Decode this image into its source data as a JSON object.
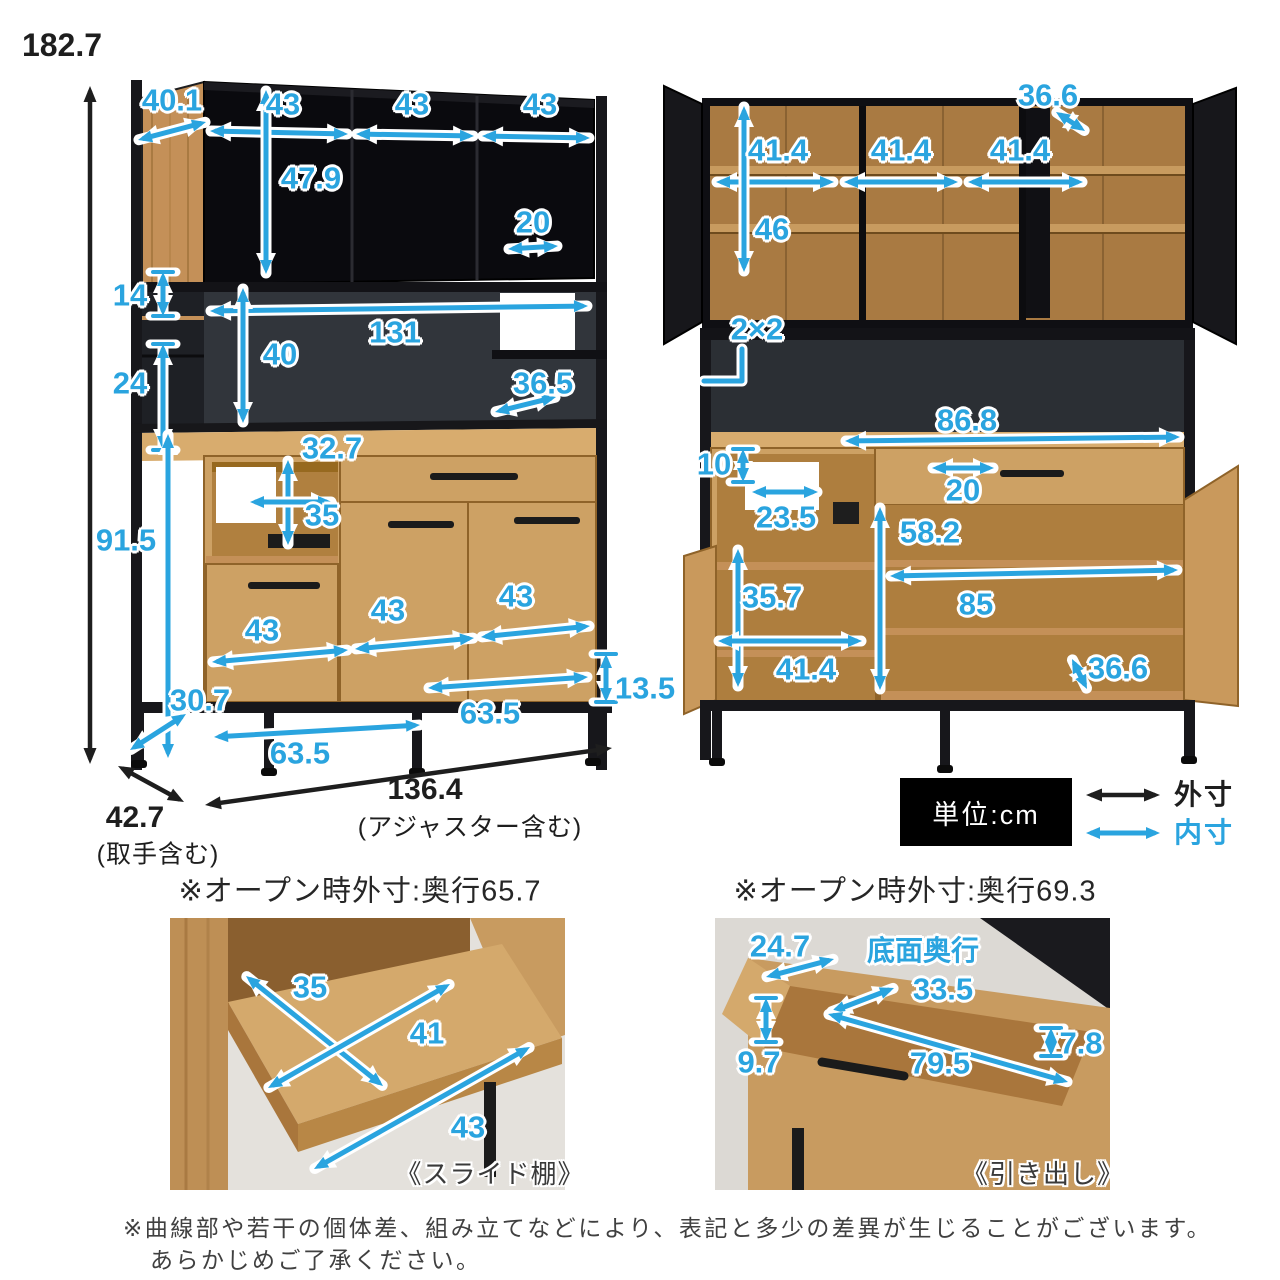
{
  "colors": {
    "accent": "#2AA4DF",
    "outer_dim": "#1E1E1E",
    "wood": "#CDA164",
    "cabinet_black": "#0A0A0E"
  },
  "legend": {
    "unit": "単位:cm",
    "outer": "外寸",
    "inner": "内寸"
  },
  "left_view": {
    "overall_height": "182.7",
    "depth": "42.7",
    "depth_note": "(取手含む)",
    "width": "136.4",
    "width_note": "(アジャスター含む)",
    "top_depth": "40.1",
    "top_w1": "43",
    "top_w2": "43",
    "top_w3": "43",
    "top_inner_h": "47.9",
    "top_gap_w": "20",
    "mid_gap_h": "14",
    "mid_inner_w": "131",
    "mid_inner_h": "40",
    "mid_left_h": "24",
    "counter_depth": "36.5",
    "niche_upper_h": "32.7",
    "niche_lower_h": "35",
    "lower_h": "91.5",
    "low_w1": "43",
    "low_w2": "43",
    "low_w3": "43",
    "base_depth": "30.7",
    "base_span_left": "63.5",
    "base_span_right": "63.5",
    "leg_h": "13.5"
  },
  "right_view": {
    "top_door_depth": "36.6",
    "top_inner_w1": "41.4",
    "top_inner_w2": "41.4",
    "top_inner_w3": "41.4",
    "top_inner_h": "46",
    "frame_size": "2×2",
    "counter_inner_w": "86.8",
    "outlet_h": "10",
    "outlet_w": "23.5",
    "drawer_handle_w": "20",
    "cavity_h": "58.2",
    "left_cavity_h": "35.7",
    "left_cavity_w": "41.4",
    "cavity_w": "85",
    "door_depth": "36.6"
  },
  "photo_left": {
    "title": "※オープン時外寸:奥行65.7",
    "shelf_depth": "35",
    "shelf_inner": "41",
    "shelf_width": "43",
    "caption": "《スライド棚》"
  },
  "photo_right": {
    "title": "※オープン時外寸:奥行69.3",
    "top_depth": "24.7",
    "bottom_depth_label": "底面奥行",
    "bottom_depth": "33.5",
    "inner_h": "9.7",
    "inner_w": "79.5",
    "gap_h": "7.8",
    "caption": "《引き出し》"
  },
  "notes": {
    "line1": "※曲線部や若干の個体差、組み立てなどにより、表記と多少の差異が生じることがございます。",
    "line2": "あらかじめご了承ください。"
  }
}
